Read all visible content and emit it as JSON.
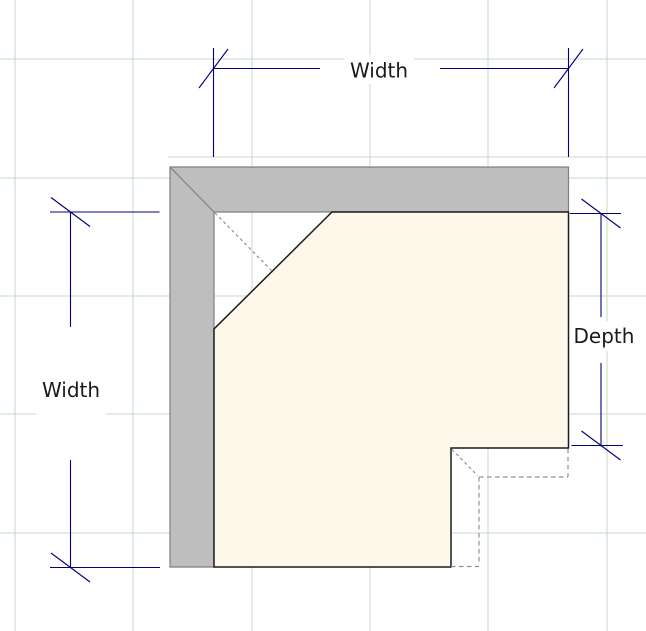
{
  "dimensions": {
    "top_width": {
      "label": "Width",
      "orientation": "horizontal"
    },
    "left_width": {
      "label": "Width",
      "orientation": "vertical"
    },
    "right_depth": {
      "label": "Depth",
      "orientation": "vertical"
    }
  },
  "colors": {
    "background": "#ffffff",
    "grid_line": "#c6d9c6",
    "wall_fill": "#bebebe",
    "wall_outline": "#7f7f7f",
    "wall_reference_line": "#ccd6cc",
    "counter_fill": "#fdf8e9",
    "counter_outline": "#1c1c1c",
    "hidden_edge": "#8f8f8f",
    "dimension_line": "#000080",
    "label_text": "#1a1a1a"
  }
}
